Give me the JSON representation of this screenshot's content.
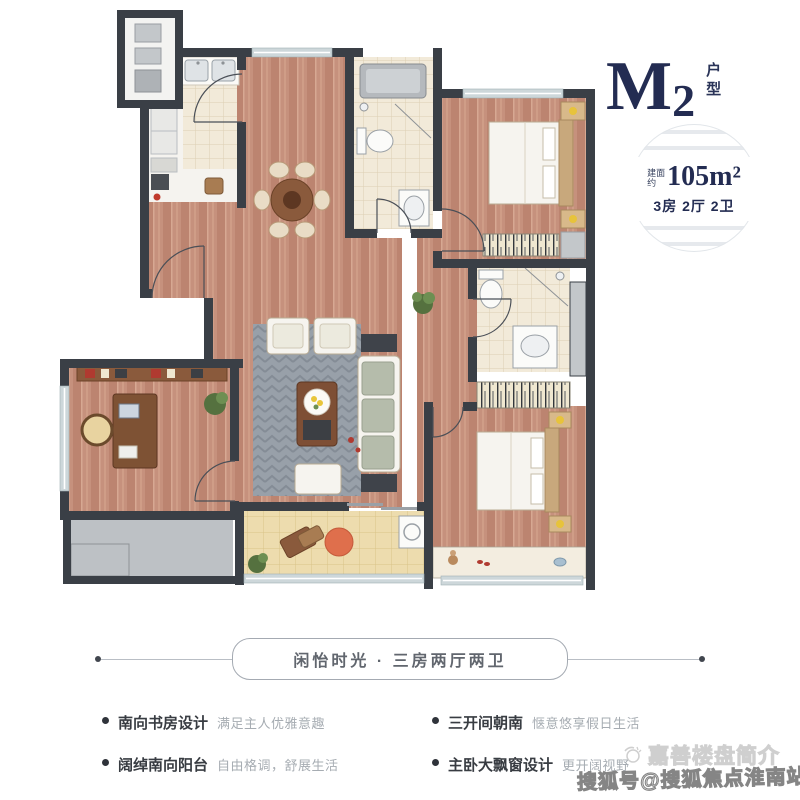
{
  "header": {
    "title_m": "M",
    "title_2": "2",
    "title_suffix": "户型",
    "badge": {
      "prefix_top": "建面",
      "prefix_bottom": "约",
      "area": "105m²",
      "layout": "3房 2厅 2卫"
    }
  },
  "banner": {
    "text": "闲怡时光 · 三房两厅两卫"
  },
  "features": [
    {
      "label": "南向书房设计",
      "desc": "满足主人优雅意趣"
    },
    {
      "label": "阔绰南向阳台",
      "desc": "自由格调，舒展生活"
    },
    {
      "label": "三开间朝南",
      "desc": "惬意悠享假日生活"
    },
    {
      "label": "主卧大飘窗设计",
      "desc": "更开阔视野"
    }
  ],
  "watermark": {
    "line1": "嘉善楼盘简介",
    "line2": "搜狐号@搜狐焦点淮南站"
  },
  "colors": {
    "navy": "#232c52",
    "wall": "#3a3f46",
    "wood_floor": "#c6917d",
    "tile": "#f2ead9",
    "balcony_tile": "#eddcae",
    "window": "#cdd7da",
    "rug": "#98a0a9",
    "platform_gray": "#bdc1c5"
  }
}
